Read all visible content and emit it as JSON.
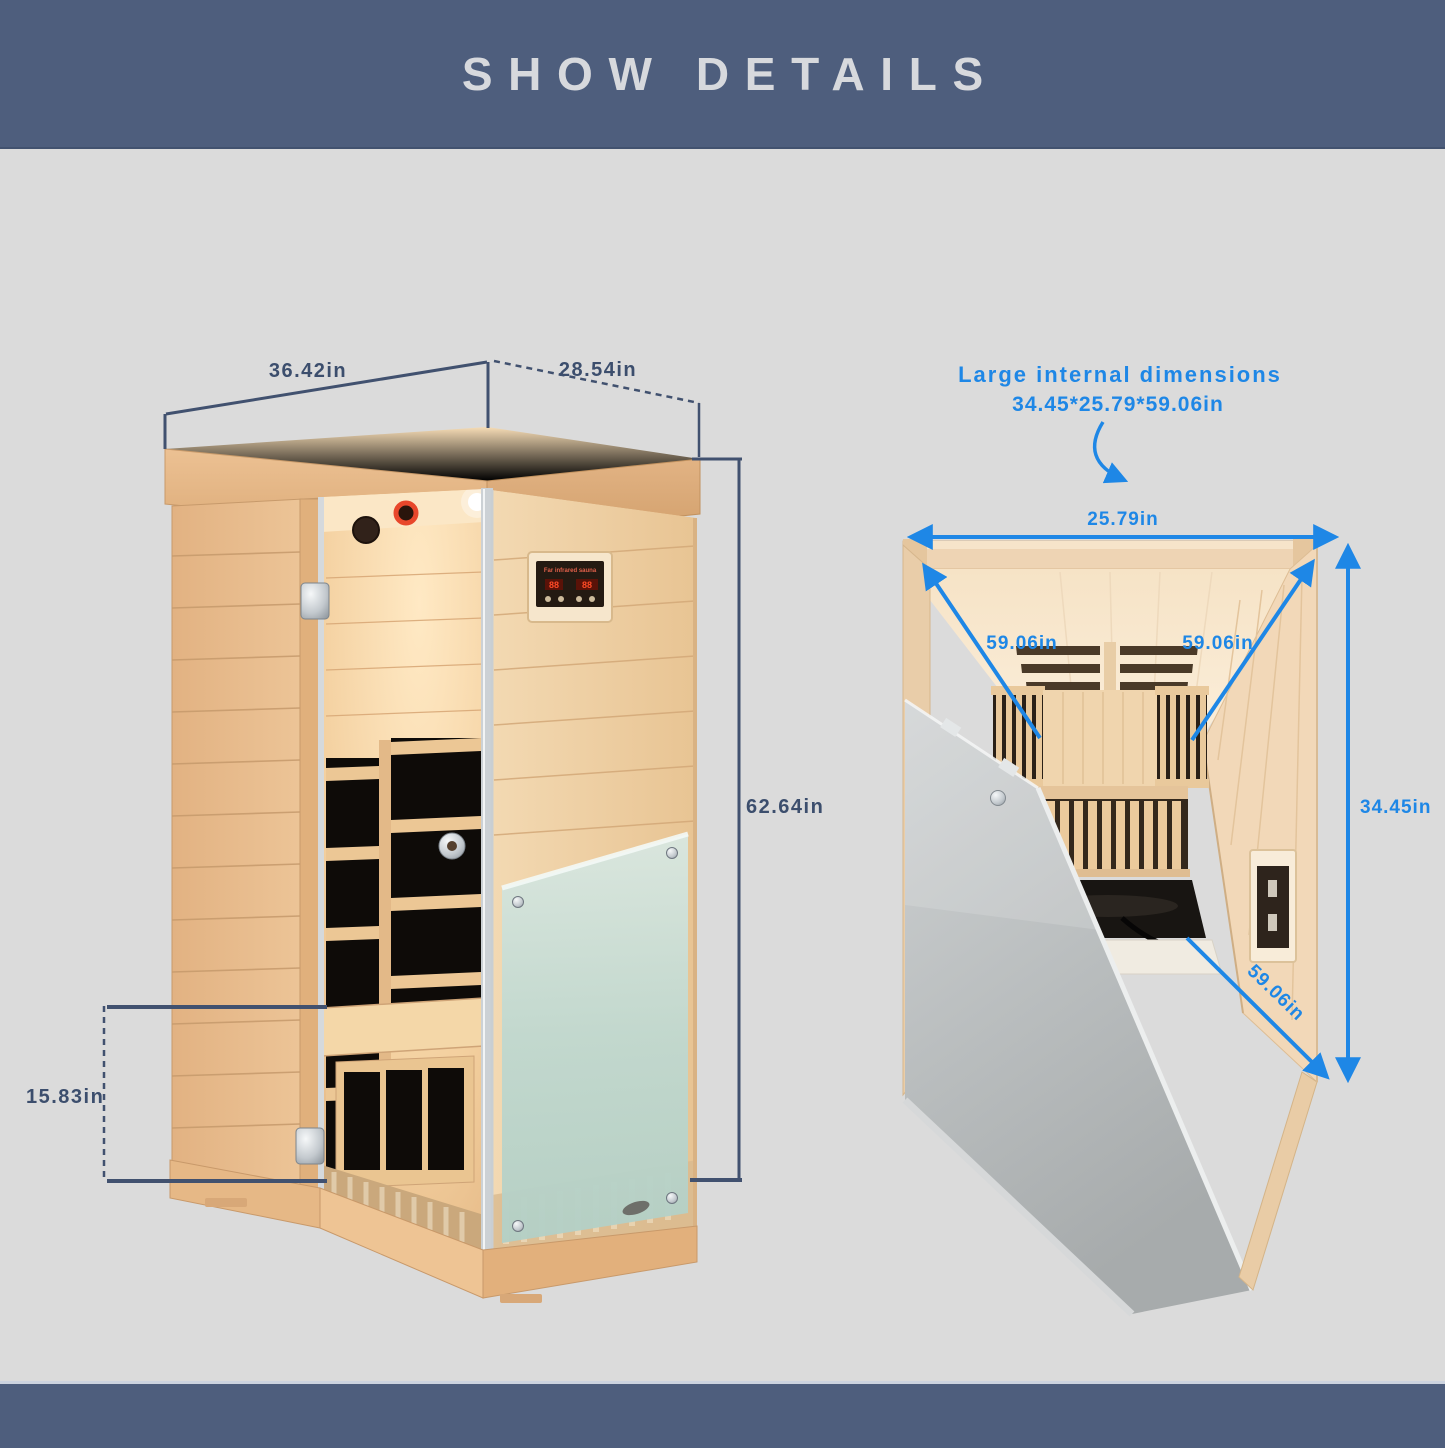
{
  "header": {
    "title": "SHOW DETAILS"
  },
  "left_figure": {
    "width_label": "36.42in",
    "depth_label": "28.54in",
    "height_label": "62.64in",
    "base_height_label": "15.83in",
    "control_panel_label": "Far infrared sauna"
  },
  "right_figure": {
    "heading": "Large internal dimensions",
    "size_summary": "34.45*25.79*59.06in",
    "internal_width_label": "25.79in",
    "diagonal_left_label": "59.06in",
    "diagonal_right_label": "59.06in",
    "internal_height_label": "34.45in",
    "door_edge_label": "59.06in"
  },
  "colors": {
    "banner": "#4e5e7d",
    "background": "#dbdbdb",
    "annotation_navy": "#41516f",
    "annotation_blue": "#1e87e6",
    "wood_light": "#f0d6ad",
    "frosted_glass": "#bdd6cd"
  }
}
